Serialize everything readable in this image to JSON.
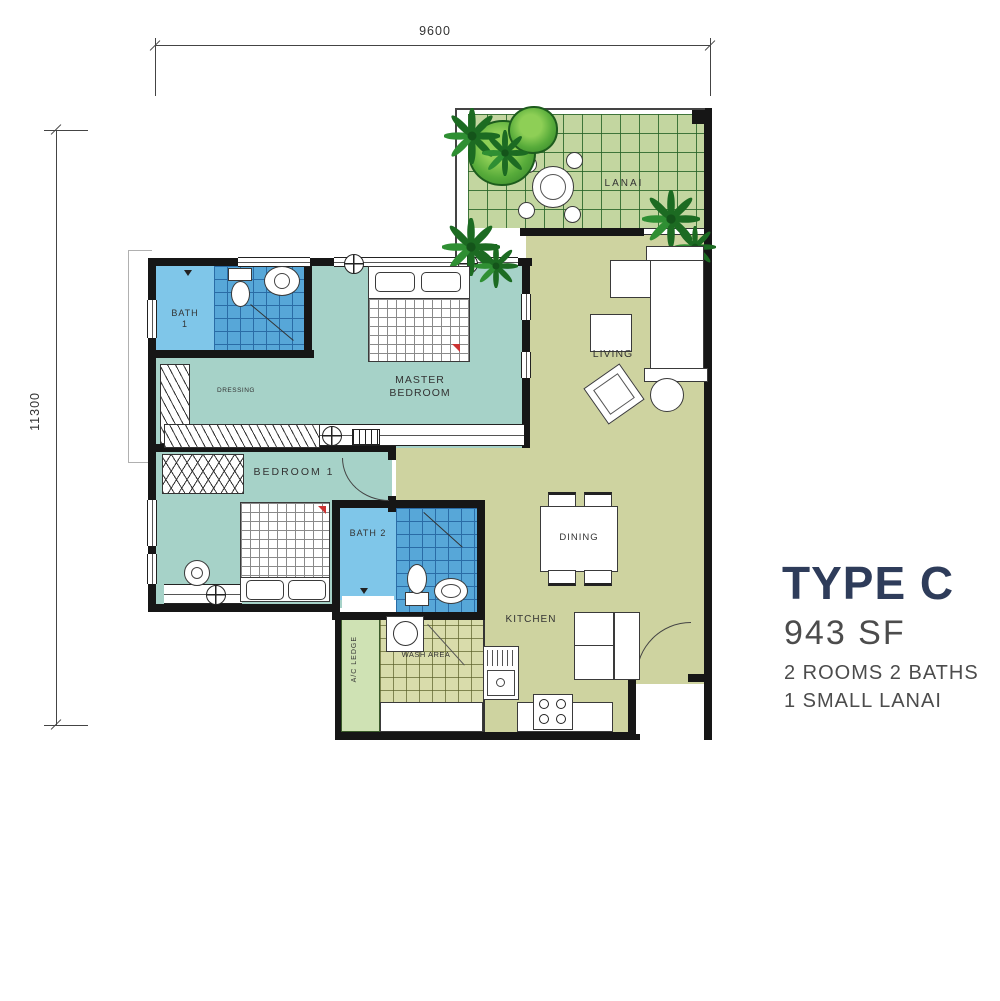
{
  "dimensions": {
    "width": "9600",
    "height": "11300"
  },
  "rooms": {
    "lanai": "LANAI",
    "living": "LIVING",
    "master_bedroom": "MASTER BEDROOM",
    "dressing": "DRESSING",
    "bath1": "BATH 1",
    "bedroom1": "BEDROOM 1",
    "bath2": "BATH 2",
    "dining": "DINING",
    "kitchen": "KITCHEN",
    "wash_area": "WASH AREA",
    "ac_ledge": "A/C LEDGE"
  },
  "info": {
    "type": "TYPE C",
    "area": "943 SF",
    "line1": "2 ROOMS 2 BATHS",
    "line2": "1 SMALL LANAI"
  },
  "colors": {
    "title": "#2e3c5a",
    "body_text": "#4c4c4c",
    "bedroom_floor": "#a6d2c8",
    "living_floor": "#ced3a0",
    "lanai_tile": "#c3d6a0",
    "bath_tile": "#57a7d8",
    "bath_room": "#7fc6e9",
    "wash_tile": "#d9dcab",
    "plant": "#1c6b22",
    "wall": "#161616"
  }
}
